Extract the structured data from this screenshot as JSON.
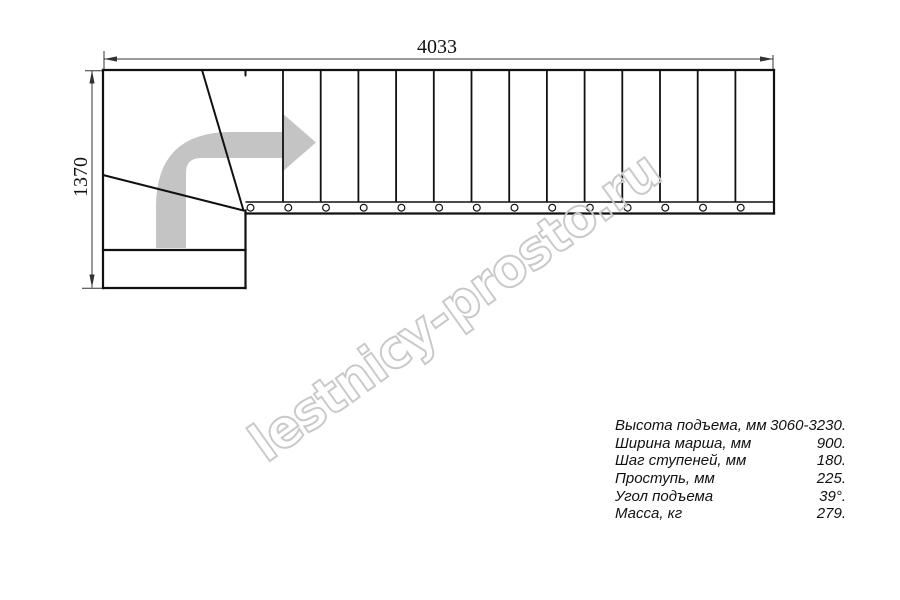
{
  "drawing": {
    "kind": "staircase-plan-top-view",
    "dimension_width_label": "4033",
    "dimension_height_label": "1370",
    "step_lines_x": [
      283,
      320.7,
      358.4,
      396.1,
      433.8,
      471.5,
      509.2,
      546.9,
      584.6,
      622.3,
      660,
      697.7,
      735.4
    ],
    "baluster_x": [
      250.5,
      288.3,
      326,
      363.7,
      401.4,
      439.1,
      476.8,
      514.5,
      552.2,
      589.9,
      627.6,
      665.3,
      703,
      740.7
    ]
  },
  "watermark": {
    "text": "lestnicy-prosto.ru"
  },
  "specs": {
    "rows": [
      {
        "label": "Высота подъема, мм",
        "value": "3060-3230."
      },
      {
        "label": "Ширина марша, мм",
        "value": "900."
      },
      {
        "label": "Шаг ступеней, мм",
        "value": "180."
      },
      {
        "label": "Проступь, мм",
        "value": "225."
      },
      {
        "label": "Угол подъема",
        "value": "39°."
      },
      {
        "label": "Масса, кг",
        "value": "279."
      }
    ]
  },
  "colors": {
    "line": "#111111",
    "dimension_line": "#333333",
    "direction_arrow": "#c4c4c4",
    "watermark_outline": "#c9c9c9"
  }
}
